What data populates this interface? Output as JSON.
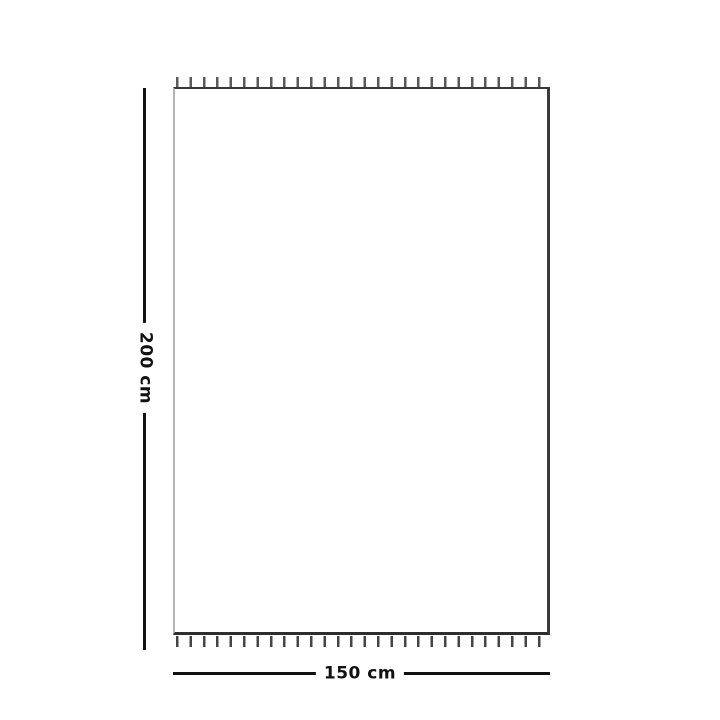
{
  "diagram": {
    "type": "product-dimension-diagram",
    "product_shape": "rectangle-with-fringe-top-and-bottom",
    "height_dimension": {
      "label": "200 cm",
      "value_cm": 200,
      "orientation": "vertical",
      "side": "left"
    },
    "width_dimension": {
      "label": "150 cm",
      "value_cm": 150,
      "orientation": "horizontal",
      "side": "bottom"
    },
    "colors": {
      "background": "#ffffff",
      "dimension_line": "#111111",
      "label_text": "#111111",
      "outline_dark": "#383838",
      "outline_light": "#b5b5b5",
      "fringe": "#555555"
    }
  }
}
